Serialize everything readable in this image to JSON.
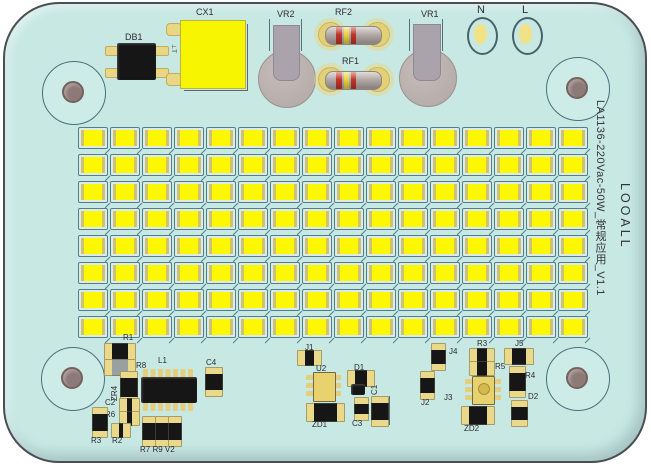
{
  "silkscreen": {
    "model": "LA1136-220Vac-50W_常规应用_V1.1",
    "brand": "LOOALL"
  },
  "top": {
    "db1": "DB1",
    "cx1": "CX1",
    "cx1_mark": "⊥T",
    "vr2": "VR2",
    "rf2": "RF2",
    "rf1": "RF1",
    "vr1": "VR1",
    "n": "N",
    "l": "L"
  },
  "led_array": {
    "rows": 8,
    "cols": 16,
    "chip_color": "#fdf800"
  },
  "bottom_left": {
    "r1": "R1",
    "r8": "R8",
    "zr4": "ZR4",
    "l1": "L1",
    "c4": "C4",
    "c2": "C2",
    "r6": "R6",
    "r3": "R3",
    "r2": "R2",
    "triple": "R7 R9 V2"
  },
  "bottom_middle": {
    "j1": "J1",
    "u2": "U2",
    "d1": "D1",
    "c1": "C1",
    "c3": "C3",
    "zd1": "ZD1"
  },
  "bottom_right": {
    "j4": "J4",
    "j5": "J5",
    "j2": "J2",
    "j3": "J3",
    "r3": "R3",
    "r5": "R5",
    "r4": "R4",
    "d2": "D2",
    "zd2": "ZD2"
  },
  "colors": {
    "board": "#c8e8e4",
    "led_yellow": "#fdf800",
    "cap_yellow": "#f8f500",
    "pad_yellow": "#e9d786",
    "component_black": "#161616",
    "varistor_gray": "#b7adab",
    "band_red": "#c23428",
    "band_yellow": "#e5d33c"
  }
}
